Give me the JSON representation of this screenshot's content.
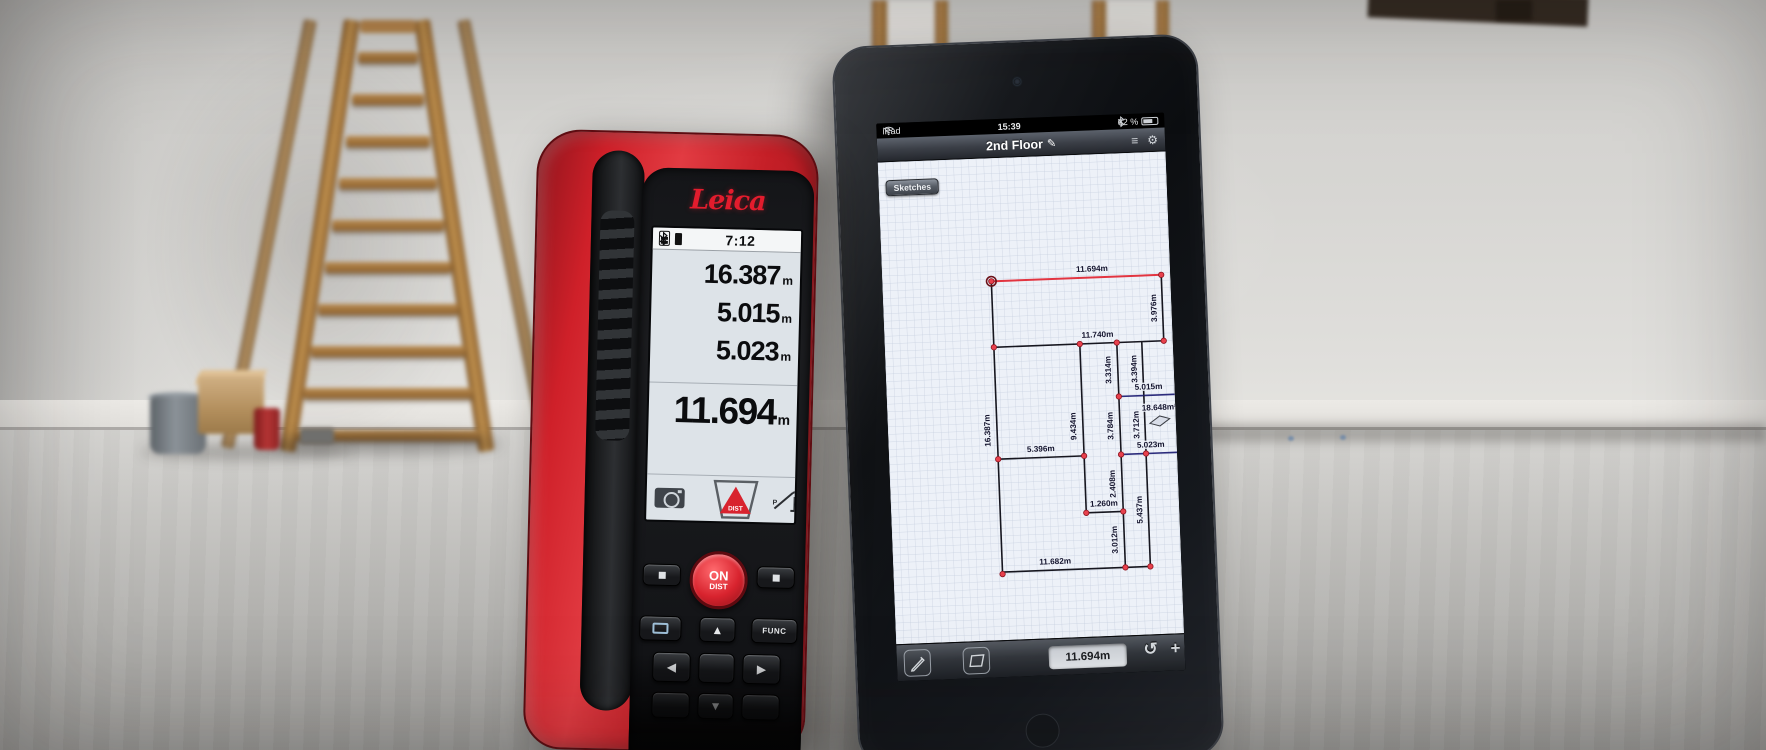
{
  "disto": {
    "brand": "Leica",
    "status": {
      "time": "7:12"
    },
    "readings": [
      {
        "value": "16.387",
        "unit": "m"
      },
      {
        "value": "5.015",
        "unit": "m"
      },
      {
        "value": "5.023",
        "unit": "m"
      }
    ],
    "main_reading": {
      "value": "11.694",
      "unit": "m"
    },
    "softkeys": {
      "dist_label": "DIST",
      "func_letter": "P"
    },
    "keypad": {
      "on": "ON",
      "dist": "DIST",
      "func": "FUNC",
      "up": "▲",
      "down": "▼",
      "left": "◀",
      "right": "▶"
    }
  },
  "ipad": {
    "status": {
      "carrier": "iPad",
      "time": "15:39",
      "battery_percent": "62 %"
    },
    "nav": {
      "title": "2nd Floor",
      "back_button": "Sketches"
    },
    "icons": {
      "edit": "✎",
      "menu": "≡",
      "gear": "⚙",
      "undo": "↺",
      "plus": "+"
    },
    "toolbar": {
      "measurement_value": "11.694m"
    },
    "sketch": {
      "area": {
        "label": "18.648m²",
        "x": 272,
        "y": 258
      },
      "segments": [
        {
          "label": "11.694m",
          "x1": 109,
          "y1": 123,
          "x2": 279,
          "y2": 123,
          "color": "red",
          "lx": 210,
          "ly": 117,
          "rot": false
        },
        {
          "label": "3.976m",
          "x1": 279,
          "y1": 123,
          "x2": 279,
          "y2": 189,
          "color": "black",
          "lx": 273,
          "ly": 156,
          "rot": true
        },
        {
          "label": "11.740m",
          "x1": 109,
          "y1": 189,
          "x2": 279,
          "y2": 189,
          "color": "black",
          "lx": 213,
          "ly": 183,
          "rot": false
        },
        {
          "label": "16.387m",
          "x1": 109,
          "y1": 123,
          "x2": 109,
          "y2": 416,
          "color": "black",
          "lx": 102,
          "ly": 272,
          "rot": true
        },
        {
          "label": "9.434m",
          "x1": 195,
          "y1": 189,
          "x2": 195,
          "y2": 358,
          "color": "black",
          "lx": 188,
          "ly": 271,
          "rot": true
        },
        {
          "label": "3.314m",
          "x1": 232,
          "y1": 189,
          "x2": 232,
          "y2": 243,
          "color": "black",
          "lx": 225,
          "ly": 216,
          "rot": true
        },
        {
          "label": "3.394m",
          "x1": 257,
          "y1": 189,
          "x2": 257,
          "y2": 243,
          "color": "black",
          "lx": 251,
          "ly": 216,
          "rot": true
        },
        {
          "label": "5.015m",
          "x1": 232,
          "y1": 243,
          "x2": 288,
          "y2": 243,
          "color": "navy",
          "lx": 262,
          "ly": 237,
          "rot": false
        },
        {
          "label": "3.784m",
          "x1": 232,
          "y1": 243,
          "x2": 232,
          "y2": 301,
          "color": "black",
          "lx": 225,
          "ly": 272,
          "rot": true
        },
        {
          "label": "3.712m",
          "x1": 257,
          "y1": 243,
          "x2": 257,
          "y2": 301,
          "color": "black",
          "lx": 251,
          "ly": 272,
          "rot": true
        },
        {
          "label": "5.396m",
          "x1": 109,
          "y1": 301,
          "x2": 195,
          "y2": 301,
          "color": "black",
          "lx": 152,
          "ly": 295,
          "rot": false
        },
        {
          "label": "5.023m",
          "x1": 232,
          "y1": 301,
          "x2": 288,
          "y2": 301,
          "color": "navy",
          "lx": 262,
          "ly": 295,
          "rot": false
        },
        {
          "label": "2.408m",
          "x1": 232,
          "y1": 301,
          "x2": 232,
          "y2": 358,
          "color": "black",
          "lx": 225,
          "ly": 330,
          "rot": true
        },
        {
          "label": "1.260m",
          "x1": 195,
          "y1": 358,
          "x2": 232,
          "y2": 358,
          "color": "black",
          "lx": 213,
          "ly": 352,
          "rot": false
        },
        {
          "label": "3.012m",
          "x1": 232,
          "y1": 358,
          "x2": 232,
          "y2": 414,
          "color": "black",
          "lx": 225,
          "ly": 386,
          "rot": true
        },
        {
          "label": "5.437m",
          "x1": 257,
          "y1": 301,
          "x2": 257,
          "y2": 414,
          "color": "black",
          "lx": 251,
          "ly": 357,
          "rot": true
        },
        {
          "label": "11.682m",
          "x1": 109,
          "y1": 414,
          "x2": 257,
          "y2": 414,
          "color": "black",
          "lx": 162,
          "ly": 408,
          "rot": false
        }
      ],
      "points": [
        [
          109,
          123
        ],
        [
          279,
          123
        ],
        [
          109,
          189
        ],
        [
          195,
          189
        ],
        [
          232,
          189
        ],
        [
          279,
          189
        ],
        [
          232,
          243
        ],
        [
          109,
          301
        ],
        [
          195,
          301
        ],
        [
          232,
          301
        ],
        [
          257,
          301
        ],
        [
          195,
          358
        ],
        [
          232,
          358
        ],
        [
          109,
          416
        ],
        [
          232,
          414
        ],
        [
          257,
          414
        ]
      ],
      "ring_point": [
        109,
        123
      ]
    }
  }
}
